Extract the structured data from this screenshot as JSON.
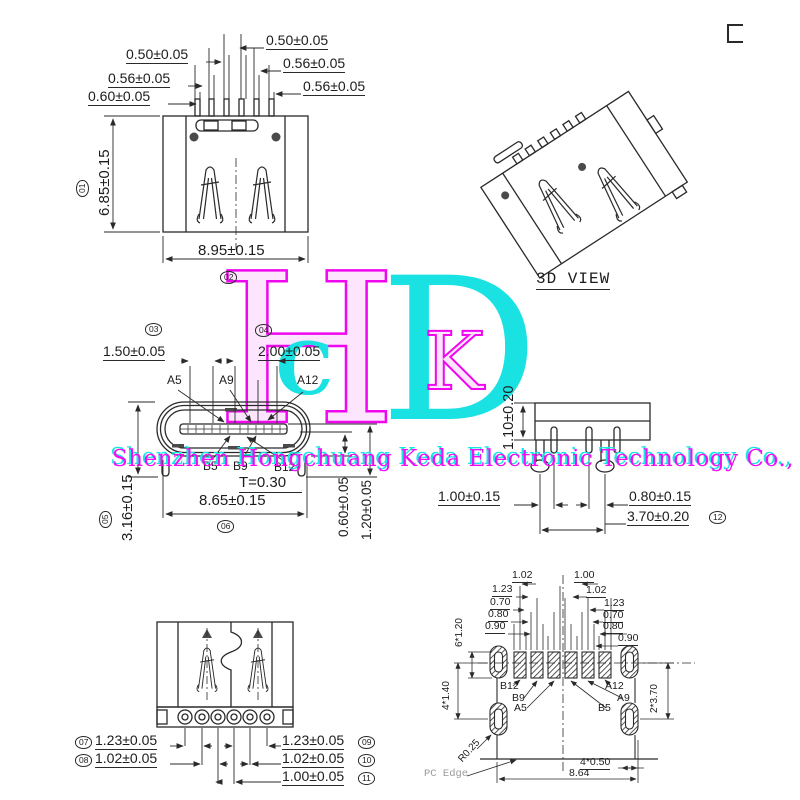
{
  "watermark": {
    "company": "Shenzhen Hongchuang Keda Electronic Technology Co., Ltd",
    "logo": {
      "h": "H",
      "d": "D",
      "c": "C",
      "k": "K"
    }
  },
  "front_view": {
    "pitch_right": "0.50±0.05",
    "pitch_left": "0.50±0.05",
    "width_right1": "0.56±0.05",
    "width_left1": "0.56±0.05",
    "width_left2": "0.60±0.05",
    "width_right2": "0.56±0.05",
    "height": "6.85±0.15",
    "balloon_height": "01",
    "width": "8.95±0.15",
    "balloon_width": "02"
  },
  "view_3d": {
    "label": "3D VIEW"
  },
  "section_view": {
    "balloon_a": "03",
    "balloon_b": "04",
    "dim_left": "1.50±0.05",
    "dim_right": "2.00±0.05",
    "pin_a5": "A5",
    "pin_a9": "A9",
    "pin_a12": "A12",
    "pin_b5": "B5",
    "pin_b9": "B9",
    "pin_b12": "B12",
    "tongue_thickness": "T=0.30",
    "width": "8.65±0.15",
    "height": "3.16±0.15",
    "balloon_height": "05",
    "balloon_width": "06",
    "dim_step1": "0.60±0.05",
    "dim_step2": "1.20±0.05"
  },
  "side_view": {
    "height": "1.10±0.20",
    "dim_left": "1.00±0.15",
    "dim_right": "0.80±0.15",
    "pin_span": "3.70±0.20",
    "balloon_span": "12"
  },
  "bottom_view": {
    "balloon_l1": "07",
    "dim_l1": "1.23±0.05",
    "balloon_l2": "08",
    "dim_l2": "1.02±0.05",
    "dim_r1": "1.23±0.05",
    "balloon_r1": "09",
    "dim_r2": "1.02±0.05",
    "balloon_r2": "10",
    "dim_r3": "1.00±0.05",
    "balloon_r3": "11"
  },
  "footprint": {
    "row1_left": "1.02",
    "row1_right": "1.00",
    "row2_left": "1.23",
    "row2_right": "1.02",
    "row3_left": "0.70",
    "row3_right": "1.23",
    "row4_left": "0.80",
    "row4_right": "0.70",
    "row5_left": "0.90",
    "row5_right": "0.80",
    "row6_right": "0.90",
    "pad_pitch": "6*1.20",
    "hole_pitch": "4*1.40",
    "hole_span": "2*3.70",
    "corner_radius": "R0.25",
    "pcb_edge": "PC Edge",
    "hole_size": "4*0.50",
    "width": "8.64",
    "pin_b12": "B12",
    "pin_b9": "B9",
    "pin_a5": "A5",
    "pin_a12": "A12",
    "pin_a9": "A9",
    "pin_b5": "B5"
  }
}
